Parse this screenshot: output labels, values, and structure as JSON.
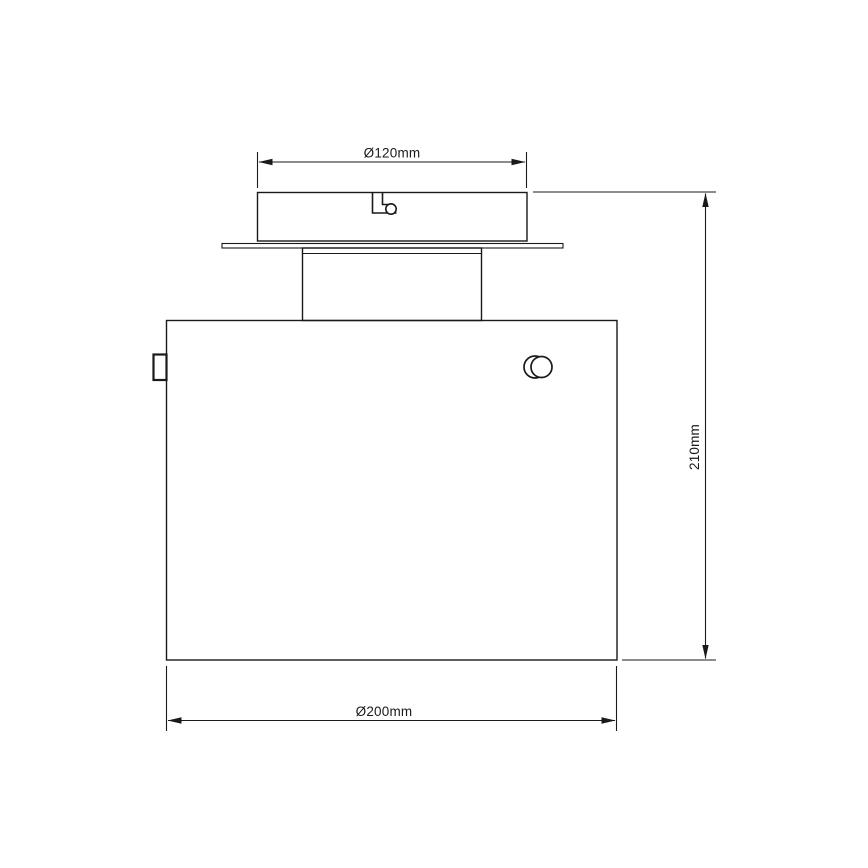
{
  "page": {
    "background_color": "#ffffff",
    "line_color": "#1a1a1a"
  },
  "drawing": {
    "type": "technical-dimension-drawing",
    "subject": "ceiling-light-fixture-front-view",
    "dimensions": {
      "canopy_diameter": {
        "label": "Ø120mm",
        "value_mm": 120
      },
      "fixture_height": {
        "label": "210mm",
        "value_mm": 210
      },
      "shade_diameter": {
        "label": "Ø200mm",
        "value_mm": 200
      }
    }
  }
}
